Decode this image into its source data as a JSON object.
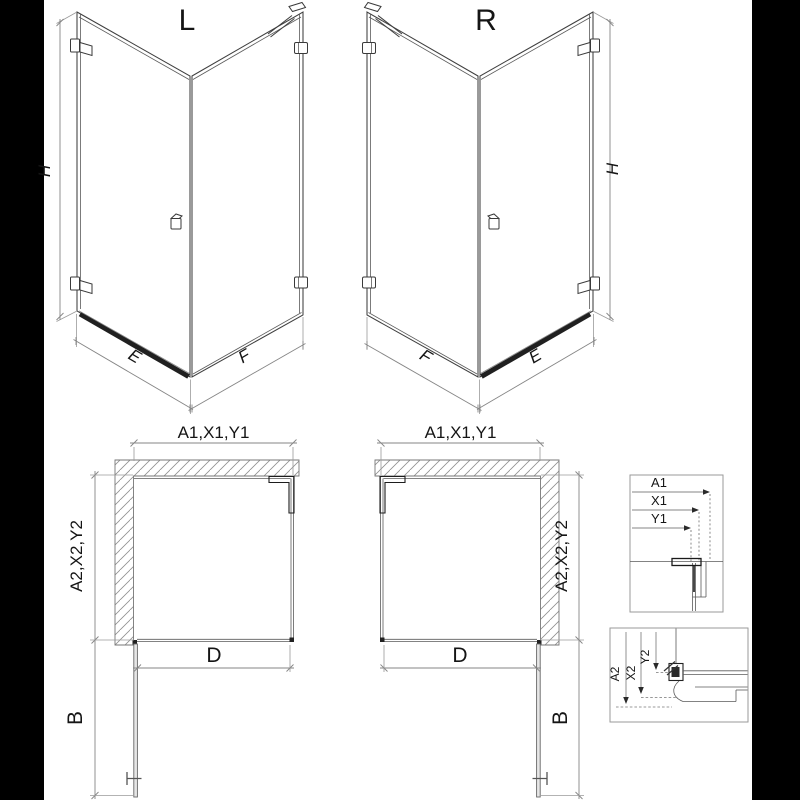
{
  "drawing": {
    "title_left_view": "L",
    "title_right_view": "R",
    "views": {
      "left_3d": {
        "title": "L",
        "dim_height": "H",
        "dim_door": "E",
        "dim_side": "F"
      },
      "right_3d": {
        "title": "R",
        "dim_height": "H",
        "dim_door": "E",
        "dim_side": "F"
      },
      "left_plan": {
        "dim_width": "A1,X1,Y1",
        "dim_depth": "A2,X2,Y2",
        "dim_opening": "D",
        "dim_door_open": "B"
      },
      "right_plan": {
        "dim_width": "A1,X1,Y1",
        "dim_depth": "A2,X2,Y2",
        "dim_opening": "D",
        "dim_door_open": "B"
      },
      "detail_wall_profile": {
        "d1": "A1",
        "d2": "X1",
        "d3": "Y1"
      },
      "detail_tray_profile": {
        "d1": "A2",
        "d2": "X2",
        "d3": "Y2"
      }
    },
    "colors": {
      "letterbox": "#000000",
      "paper": "#ffffff",
      "line": "#3f3f3f",
      "dim_line": "#858585",
      "dark_detail": "#1d1d1d",
      "hatch": "#8f8f8f"
    }
  }
}
